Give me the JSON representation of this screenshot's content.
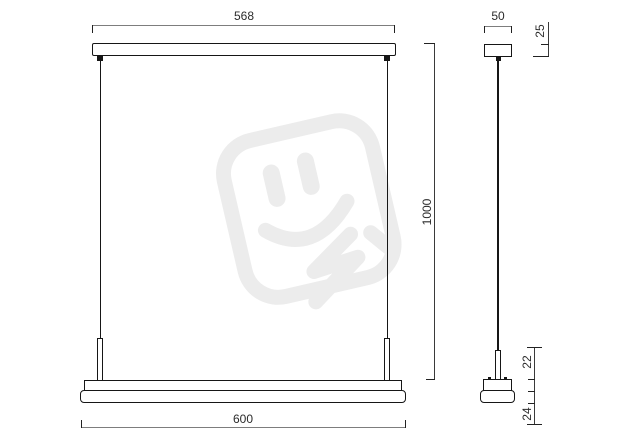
{
  "drawing": {
    "kind": "technical-dimension-drawing",
    "subject": "linear-pendant-luminaire",
    "units_implied": "mm"
  },
  "front_view": {
    "dim_canopy_width": "568",
    "dim_fixture_width": "600",
    "dim_suspension_height": "1000"
  },
  "side_view": {
    "dim_width": "50",
    "dim_canopy_height": "25",
    "dim_body_upper_height": "22",
    "dim_body_lower_height": "24"
  },
  "colors": {
    "background": "#ffffff",
    "object_line": "#161616",
    "dimension_line": "#7d7d7d",
    "dimension_text": "#2b2b2b",
    "watermark": "#ececec"
  },
  "icons": {
    "watermark": "plug-smiley-watermark-icon"
  }
}
